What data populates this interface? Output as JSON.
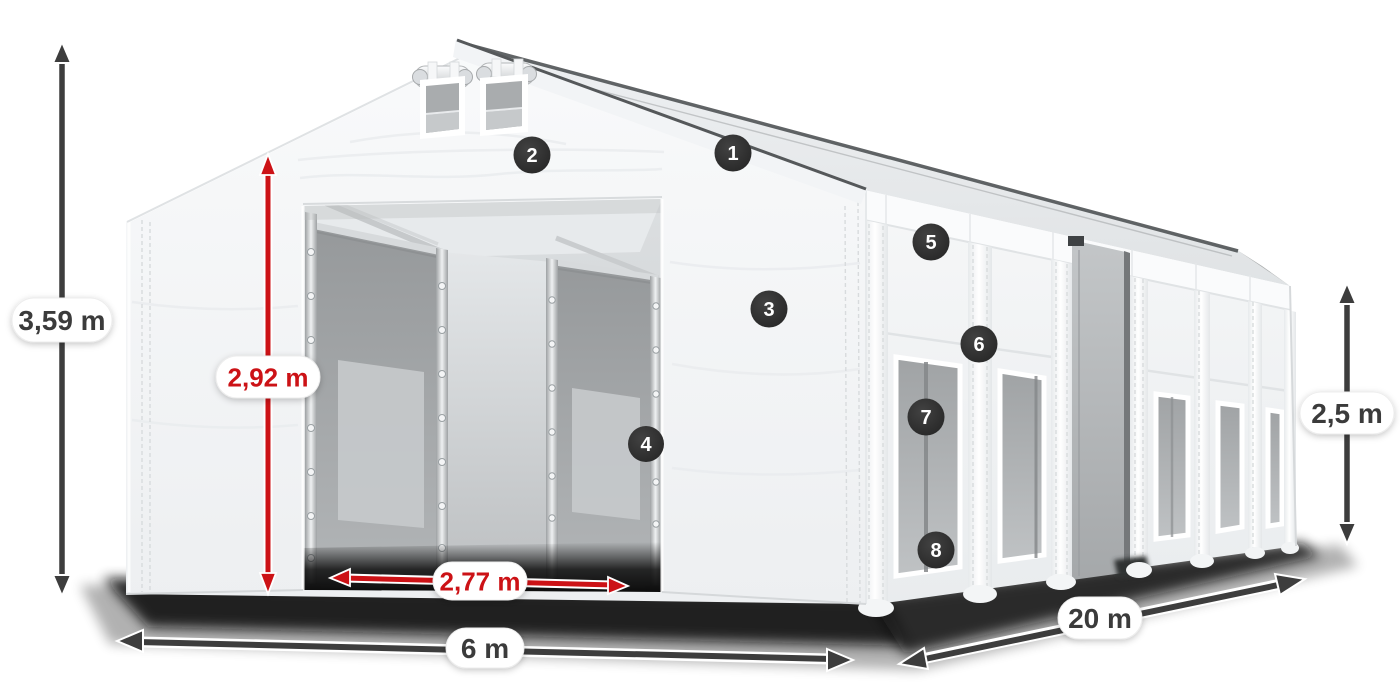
{
  "figure": {
    "type": "product-dimension-diagram",
    "subject": "white-storage-tent"
  },
  "dimensions": {
    "total_height": "3,59 m",
    "entrance_height": "2,92 m",
    "entrance_width": "2,77 m",
    "front_width": "6 m",
    "length": "20 m",
    "side_height": "2,5 m"
  },
  "callouts": [
    {
      "number": "1"
    },
    {
      "number": "2"
    },
    {
      "number": "3"
    },
    {
      "number": "4"
    },
    {
      "number": "5"
    },
    {
      "number": "6"
    },
    {
      "number": "7"
    },
    {
      "number": "8"
    }
  ],
  "colors": {
    "accent_red": "#cc1216",
    "arrow_dark": "#3d3d3d",
    "callout_bg": "#2b2b2b",
    "pill_bg": "#ffffff",
    "label_text": "#3b3b3b",
    "fabric_white": "#f4f6f7",
    "mesh_gray": "#a6a9ab"
  }
}
